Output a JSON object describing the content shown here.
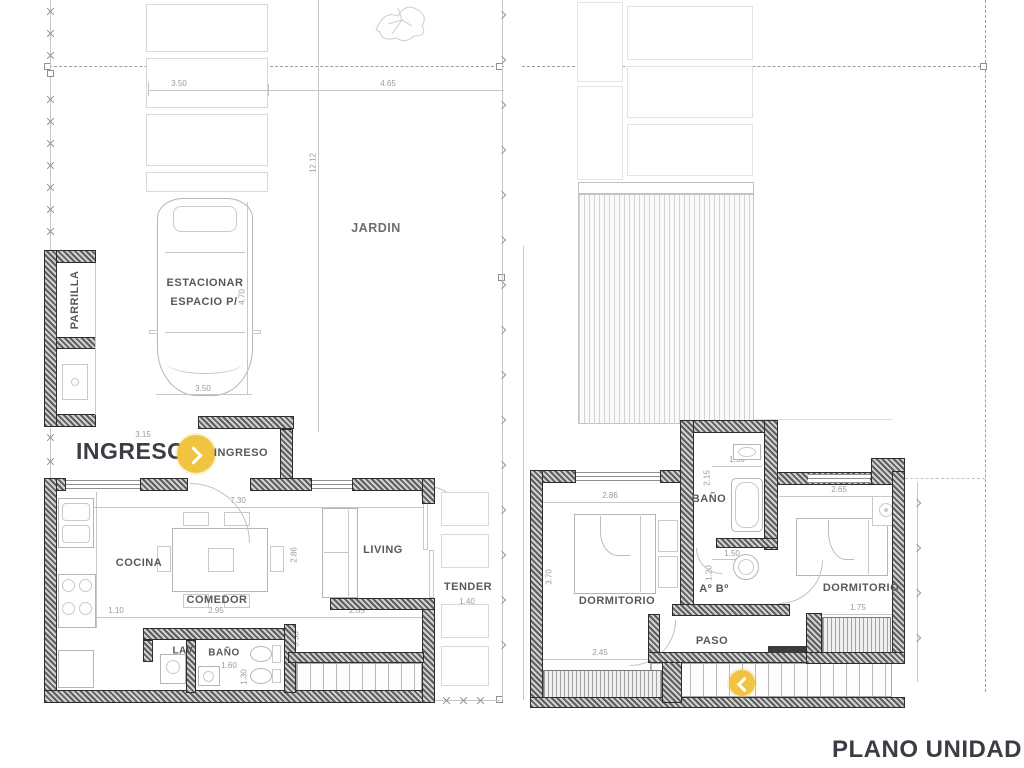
{
  "title": {
    "label": "PLANO UNIDAD"
  },
  "colors": {
    "accent_yellow": "#F0C441",
    "ink": "#3B3E44",
    "room_label": "#595959",
    "dim_text": "#9B9B9B"
  },
  "entry": {
    "headline": "INGRESO",
    "door_label": "INGRESO"
  },
  "site": {
    "jardin_label": "JARDIN",
    "parrilla_label": "PARRILLA",
    "parking_label_line1": "ESTACIONAR",
    "parking_label_line2": "ESPACIO P/",
    "dims": {
      "drive_width": "3.50",
      "garden_width": "4.65",
      "lot_depth": "12.12",
      "car_length": "4.70",
      "car_width": "3.50",
      "roof_width": "4.65",
      "entry_width": "3.15"
    }
  },
  "ground_floor": {
    "labels": {
      "cocina": "COCINA",
      "comedor": "COMEDOR",
      "living": "LIVING",
      "tender": "TENDER",
      "lavadero": "LAV.",
      "bano": "BAÑO"
    },
    "dims": {
      "interior_width": "7.30",
      "living_depth": "2.86",
      "counter_depth": "0.60",
      "kitchen_aisle": "1.10",
      "comedor_width": "2.95",
      "living_width": "2.65",
      "lav_width": "0.90",
      "bano_width": "1.60",
      "bano_depth": "1.30",
      "stair_wall": "0.50",
      "tender_width": "1.40"
    }
  },
  "upper_floor": {
    "labels": {
      "dormitorio_left": "DORMITORIO",
      "dormitorio_right": "DORMITORIO",
      "bano": "BAÑO",
      "antebano": "Aº Bº",
      "paso": "PASO"
    },
    "dims": {
      "dorm_left_width": "2.86",
      "dorm_left_depth": "3.70",
      "dorm_left_lower_width": "2.45",
      "balcony_left_depth": "0.60",
      "stair_opening": "1.50",
      "paso_width": "1.15",
      "bano_width": "1.50",
      "bano_depth": "2.15",
      "antebano_width": "1.50",
      "antebano_depth": "1.20",
      "dorm_right_width": "2.65",
      "dorm_right_depth": "2.75",
      "balcony_right_width": "1.75",
      "balcony_right_depth": "0.60"
    }
  }
}
